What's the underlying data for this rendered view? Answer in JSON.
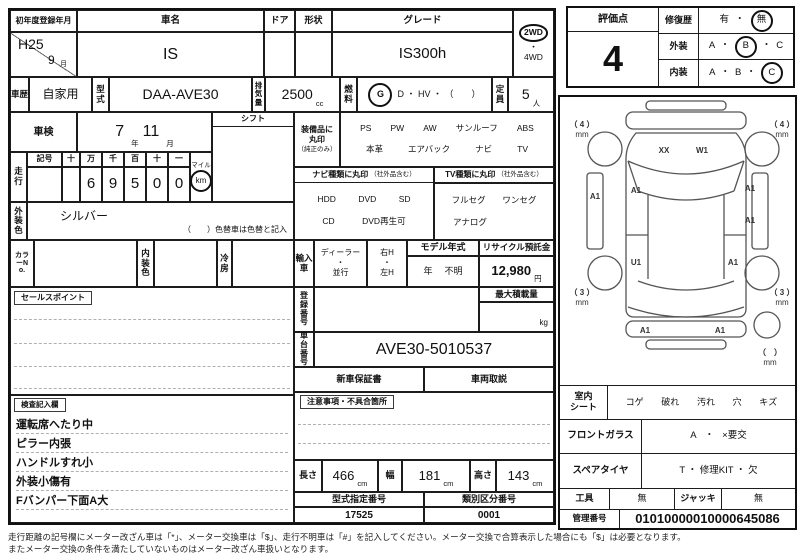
{
  "head": {
    "reg_label": "初年度登録年月",
    "reg_year": "H25",
    "reg_month": "9",
    "month_unit": "月",
    "name_label": "車名",
    "name": "IS",
    "door_label": "ドア",
    "shape_label": "形状",
    "grade_label": "グレード",
    "grade": "IS300h",
    "wd2": "2WD",
    "dot": "・",
    "wd4": "4WD"
  },
  "spec": {
    "history_label": "車歴",
    "history": "自家用",
    "model_label": "型式",
    "model": "DAA-AVE30",
    "disp_label": "排気量",
    "disp": "2500",
    "disp_unit": "cc",
    "fuel_label": "燃料",
    "fuel_g": "G",
    "fuel_rest": "D ・ HV ・ （　　）",
    "cap_label": "定員",
    "cap": "5",
    "cap_unit": "人"
  },
  "shaken": {
    "label": "車検",
    "year": "7",
    "year_unit": "年",
    "month": "11",
    "month_unit": "月"
  },
  "shift": {
    "label": "シフト"
  },
  "mileage": {
    "label": "走行",
    "symbol_label": "記号",
    "cols": [
      "十",
      "万",
      "千",
      "百",
      "十",
      "一"
    ],
    "digits": [
      "",
      "6",
      "9",
      "5",
      "0",
      "0"
    ],
    "mile": "マイル",
    "km": "km"
  },
  "equip": {
    "t1": "装備品に",
    "t2": "丸印",
    "t3": "（純正のみ）",
    "row1": [
      "PS",
      "PW",
      "AW",
      "サンルーフ",
      "ABS"
    ],
    "row2": [
      "本革",
      "エアバック",
      "ナビ",
      "TV"
    ]
  },
  "nav": {
    "title": "ナビ種類に丸印",
    "note": "（社外品含む）",
    "row1": [
      "HDD",
      "DVD",
      "SD"
    ],
    "row2": [
      "CD",
      "DVD再生可"
    ]
  },
  "tv": {
    "title": "TV種類に丸印",
    "note": "（社外品含む）",
    "row1": [
      "フルセグ",
      "ワンセグ"
    ],
    "row2": [
      "アナログ"
    ]
  },
  "ext_color": {
    "label": "外装色",
    "value": "シルバー",
    "note": "（　　）色替車は色替と記入"
  },
  "color_row": {
    "no_label": "カラーNo.",
    "interior_label": "内装色",
    "ac_label": "冷房"
  },
  "import": {
    "label": "輸入車",
    "dealer": "ディーラー",
    "dot": "・",
    "parallel": "並行",
    "rh": "右H",
    "lh": "左H",
    "my_label": "モデル年式",
    "my_unit": "年",
    "my_value": "不明",
    "rec_label": "リサイクル預託金",
    "rec_value": "12,980",
    "yen": "円"
  },
  "reg_no": {
    "label": "登録番号",
    "max_label": "最大積載量",
    "kg": "kg"
  },
  "chassis": {
    "label": "車台番号",
    "value": "AVE30-5010537"
  },
  "docs": {
    "warranty": "新車保証書",
    "manual": "車両取説"
  },
  "sales": {
    "label": "セールスポイント"
  },
  "caution": {
    "label": "注意事項・不具合箇所"
  },
  "inspect": {
    "label": "検査記入欄",
    "notes": [
      "運転席へたり中",
      "ピラー内張",
      "ハンドルすれ小",
      "外装小傷有",
      "Fバンパー下面A大"
    ]
  },
  "dims": {
    "len_label": "長さ",
    "len": "466",
    "wid_label": "幅",
    "wid": "181",
    "hei_label": "高さ",
    "hei": "143",
    "unit": "cm"
  },
  "typeno": {
    "model_label": "型式指定番号",
    "model": "17525",
    "class_label": "類別区分番号",
    "class_no": "0001"
  },
  "eval": {
    "score_label": "評価点",
    "score": "4",
    "repair_label": "修復歴",
    "yes": "有",
    "no": "無",
    "ext_label": "外装",
    "int_label": "内装",
    "a": "A",
    "b": "B",
    "c": "C",
    "dot": "・"
  },
  "diagram": {
    "mm": "mm",
    "tl": "（ 4 ）",
    "tr": "（ 4 ）",
    "bl": "（ 3 ）",
    "br": "（ 3 ）",
    "spare": "（　）",
    "xx": "XX",
    "w1": "W1",
    "left_rocker": "A1",
    "left_door": "A1",
    "right_front": "A1",
    "right_mid": "A1",
    "left_rear": "U1",
    "right_rear": "A1",
    "rear_left": "A1",
    "rear_right": "A1"
  },
  "cond": {
    "seat_l1": "室内",
    "seat_l2": "シート",
    "seat_items": [
      "コゲ",
      "破れ",
      "汚れ",
      "穴",
      "キズ"
    ],
    "glass_label": "フロントガラス",
    "glass_a": "A",
    "glass_dot": "・",
    "glass_x": "×要交",
    "spare_label": "スペアタイヤ",
    "spare_value": "T ・ 修理KIT ・ 欠",
    "tools_label": "工具",
    "tools_value": "無",
    "jack_label": "ジャッキ",
    "jack_value": "無",
    "mgmt_label": "管理番号",
    "mgmt_value": "01010000010000645086"
  },
  "footer": {
    "line1": "走行距離の記号欄にメーター改ざん車は「*」、メーター交換車は「$」、走行不明車は「#」を記入してください。メーター交換で合算表示した場合にも「$」は必要となります。",
    "line2": "またメーター交換の条件を満たしていないものはメーター改ざん車扱いとなります。"
  }
}
